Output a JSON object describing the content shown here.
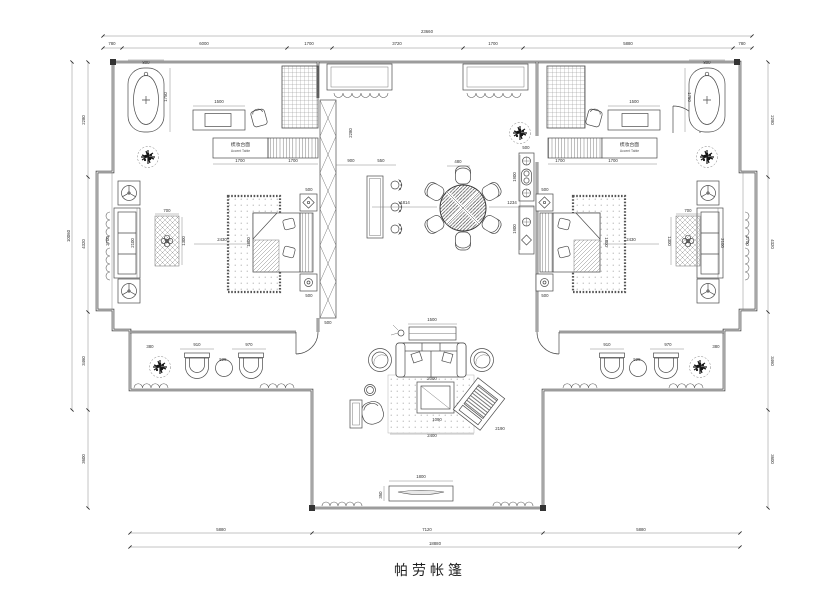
{
  "title": {
    "text": "帕劳帐篷"
  },
  "labels": {
    "left_counter_cn": "梳妆台面",
    "left_counter_en": "Accent Table",
    "right_counter_cn": "梳妆台面",
    "right_counter_en": "Accent Table"
  },
  "colors": {
    "line": "#3a3a3a",
    "dim_text": "#333333",
    "background": "#ffffff"
  },
  "dimensions": {
    "top_total": "23660",
    "top_chain": [
      "780",
      "6000",
      "1700",
      "3720",
      "1700",
      "5880",
      "780"
    ],
    "bottom_chain": [
      "5880",
      "7120",
      "5880"
    ],
    "bottom_total": "18880",
    "left_chain": [
      "2280",
      "4320",
      "3460",
      "3600"
    ],
    "left_total": "10060",
    "right_chain": [
      "2280",
      "4320",
      "3460",
      "3600"
    ]
  },
  "annotations": [
    {
      "text": "23660",
      "x": 427,
      "y": 33,
      "r": 0
    },
    {
      "text": "780",
      "x": 112,
      "y": 45,
      "r": 0
    },
    {
      "text": "6000",
      "x": 204,
      "y": 45,
      "r": 0
    },
    {
      "text": "1700",
      "x": 309,
      "y": 45,
      "r": 0
    },
    {
      "text": "3720",
      "x": 397,
      "y": 45,
      "r": 0
    },
    {
      "text": "1700",
      "x": 493,
      "y": 45,
      "r": 0
    },
    {
      "text": "5880",
      "x": 628,
      "y": 45,
      "r": 0
    },
    {
      "text": "780",
      "x": 742,
      "y": 45,
      "r": 0
    },
    {
      "text": "5880",
      "x": 221,
      "y": 531,
      "r": 0
    },
    {
      "text": "7120",
      "x": 427,
      "y": 531,
      "r": 0
    },
    {
      "text": "5880",
      "x": 641,
      "y": 531,
      "r": 0
    },
    {
      "text": "18880",
      "x": 435,
      "y": 545,
      "r": 0
    },
    {
      "text": "2280",
      "x": 85,
      "y": 120,
      "r": -90
    },
    {
      "text": "4320",
      "x": 85,
      "y": 244,
      "r": -90
    },
    {
      "text": "3460",
      "x": 85,
      "y": 361,
      "r": -90
    },
    {
      "text": "3600",
      "x": 85,
      "y": 459,
      "r": -90
    },
    {
      "text": "10060",
      "x": 70,
      "y": 236,
      "r": -90
    },
    {
      "text": "2280",
      "x": 771,
      "y": 120,
      "r": 90
    },
    {
      "text": "4320",
      "x": 771,
      "y": 244,
      "r": 90
    },
    {
      "text": "3460",
      "x": 771,
      "y": 361,
      "r": 90
    },
    {
      "text": "3600",
      "x": 771,
      "y": 459,
      "r": 90
    },
    {
      "text": "2700",
      "x": 109,
      "y": 241,
      "r": -90
    },
    {
      "text": "2700",
      "x": 746,
      "y": 241,
      "r": 90
    },
    {
      "text": "2100",
      "x": 134,
      "y": 243,
      "r": -90
    },
    {
      "text": "2100",
      "x": 721,
      "y": 243,
      "r": 90
    },
    {
      "text": "700",
      "x": 167,
      "y": 212,
      "r": 0
    },
    {
      "text": "1300",
      "x": 185,
      "y": 241,
      "r": -90
    },
    {
      "text": "700",
      "x": 688,
      "y": 212,
      "r": 0
    },
    {
      "text": "1300",
      "x": 668,
      "y": 241,
      "r": 90
    },
    {
      "text": "2430",
      "x": 222,
      "y": 241,
      "r": 0
    },
    {
      "text": "2430",
      "x": 631,
      "y": 241,
      "r": 0
    },
    {
      "text": "1800",
      "x": 250,
      "y": 242,
      "r": -90
    },
    {
      "text": "1800",
      "x": 605,
      "y": 242,
      "r": 90
    },
    {
      "text": "500",
      "x": 309,
      "y": 191,
      "r": 0
    },
    {
      "text": "500",
      "x": 309,
      "y": 297,
      "r": 0
    },
    {
      "text": "500",
      "x": 545,
      "y": 191,
      "r": 0
    },
    {
      "text": "500",
      "x": 545,
      "y": 297,
      "r": 0
    },
    {
      "text": "500",
      "x": 328,
      "y": 324,
      "r": 0
    },
    {
      "text": "2280",
      "x": 352,
      "y": 133,
      "r": -90
    },
    {
      "text": "900",
      "x": 351,
      "y": 162,
      "r": 0
    },
    {
      "text": "550",
      "x": 381,
      "y": 162,
      "r": 0
    },
    {
      "text": "1814",
      "x": 405,
      "y": 204,
      "r": 0
    },
    {
      "text": "1234",
      "x": 512,
      "y": 204,
      "r": 0
    },
    {
      "text": "480",
      "x": 458,
      "y": 163,
      "r": 0
    },
    {
      "text": "500",
      "x": 526,
      "y": 149,
      "r": 0
    },
    {
      "text": "1900",
      "x": 516,
      "y": 177,
      "r": -90
    },
    {
      "text": "1900",
      "x": 516,
      "y": 229,
      "r": -90
    },
    {
      "text": "800",
      "x": 146,
      "y": 64,
      "r": 0
    },
    {
      "text": "1750",
      "x": 167,
      "y": 97,
      "r": -90
    },
    {
      "text": "1500",
      "x": 219,
      "y": 103,
      "r": 0
    },
    {
      "text": "1700",
      "x": 240,
      "y": 162,
      "r": 0
    },
    {
      "text": "1700",
      "x": 293,
      "y": 162,
      "r": 0
    },
    {
      "text": "800",
      "x": 707,
      "y": 64,
      "r": 0
    },
    {
      "text": "1750",
      "x": 688,
      "y": 97,
      "r": 90
    },
    {
      "text": "1500",
      "x": 634,
      "y": 103,
      "r": 0
    },
    {
      "text": "1700",
      "x": 613,
      "y": 162,
      "r": 0
    },
    {
      "text": "1700",
      "x": 560,
      "y": 162,
      "r": 0
    },
    {
      "text": "1500",
      "x": 432,
      "y": 321,
      "r": 0
    },
    {
      "text": "2000",
      "x": 432,
      "y": 380,
      "r": 0
    },
    {
      "text": "2400",
      "x": 432,
      "y": 437,
      "r": 0
    },
    {
      "text": "2190",
      "x": 500,
      "y": 430,
      "r": 0
    },
    {
      "text": "1090",
      "x": 437,
      "y": 421,
      "r": 0
    },
    {
      "text": "1800",
      "x": 421,
      "y": 478,
      "r": 0
    },
    {
      "text": "350",
      "x": 382,
      "y": 495,
      "r": -90
    },
    {
      "text": "910",
      "x": 197,
      "y": 346,
      "r": 0
    },
    {
      "text": "970",
      "x": 249,
      "y": 346,
      "r": 0
    },
    {
      "text": "525",
      "x": 223,
      "y": 361,
      "r": 0
    },
    {
      "text": "380",
      "x": 150,
      "y": 348,
      "r": 0
    },
    {
      "text": "910",
      "x": 607,
      "y": 346,
      "r": 0
    },
    {
      "text": "970",
      "x": 668,
      "y": 346,
      "r": 0
    },
    {
      "text": "525",
      "x": 637,
      "y": 361,
      "r": 0
    },
    {
      "text": "380",
      "x": 716,
      "y": 348,
      "r": 0
    }
  ]
}
